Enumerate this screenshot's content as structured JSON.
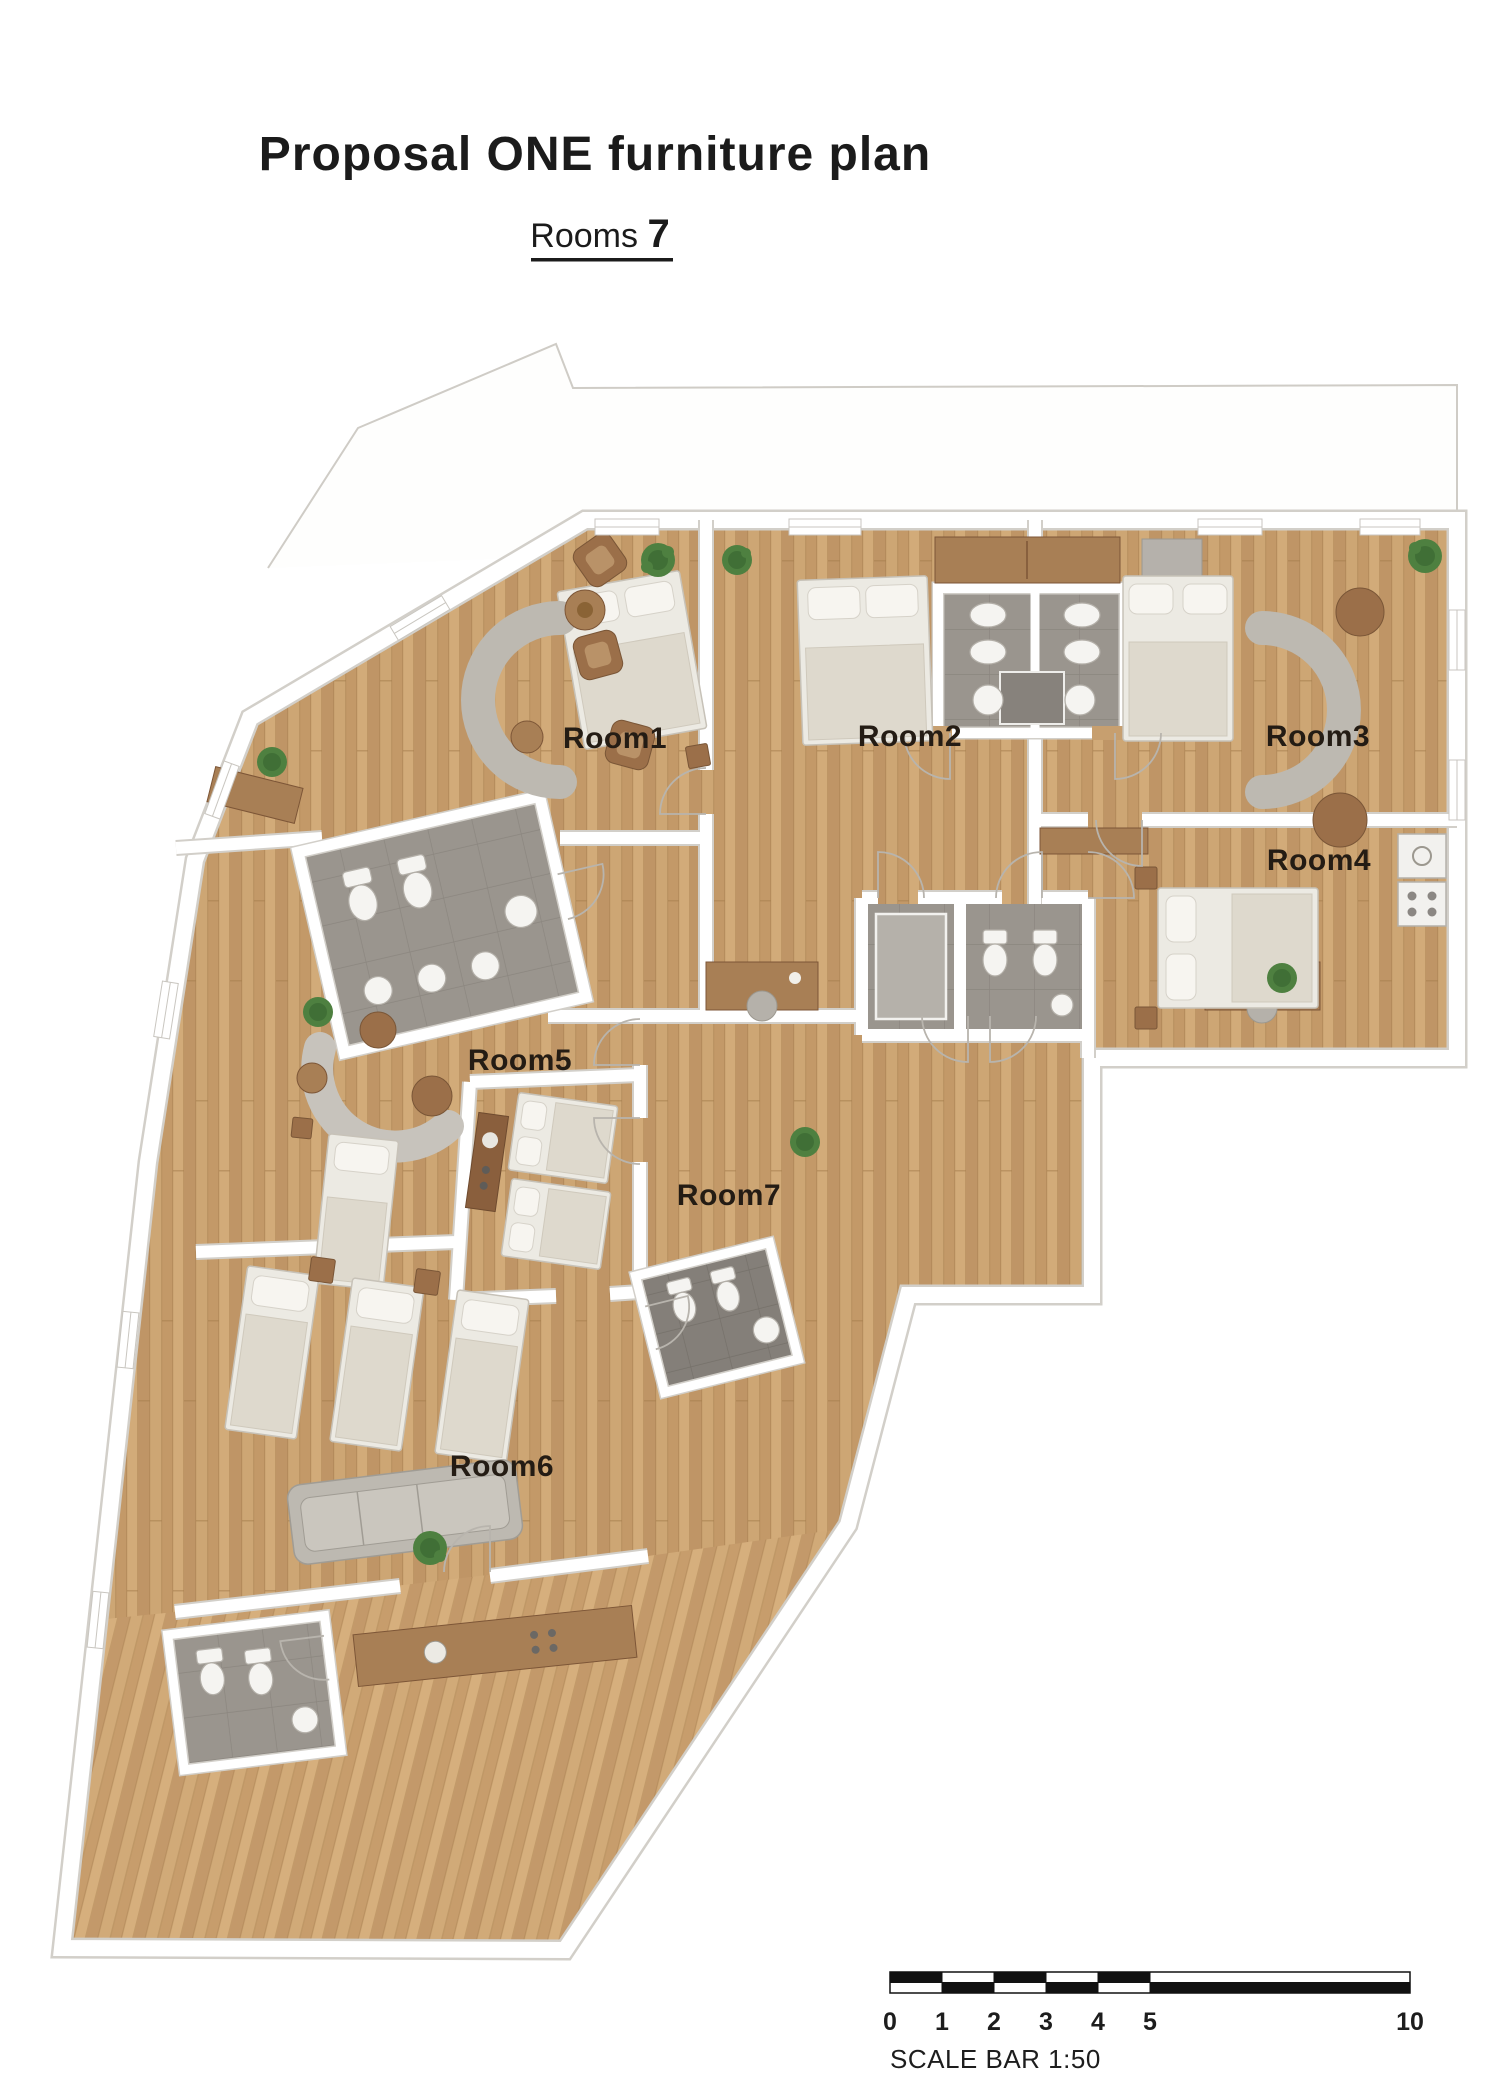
{
  "header": {
    "title": "Proposal ONE furniture plan",
    "rooms_label": "Rooms",
    "rooms_count": "7"
  },
  "rooms": [
    {
      "id": "room-1",
      "label": "Room1"
    },
    {
      "id": "room-2",
      "label": "Room2"
    },
    {
      "id": "room-3",
      "label": "Room3"
    },
    {
      "id": "room-4",
      "label": "Room4"
    },
    {
      "id": "room-5",
      "label": "Room5"
    },
    {
      "id": "room-6",
      "label": "Room6"
    },
    {
      "id": "room-7",
      "label": "Room7"
    }
  ],
  "scalebar": {
    "caption": "SCALE BAR 1:50",
    "ticks": [
      "0",
      "1",
      "2",
      "3",
      "4",
      "5",
      "10"
    ]
  },
  "legend_colors": {
    "wood_floor": "#c79f6f",
    "tile_floor": "#9a958e",
    "dark_tile_floor": "#847f79",
    "wall": "#ffffff",
    "plant": "#4e8040",
    "label_text": "#241c14",
    "scalebar_ink": "#111111"
  }
}
